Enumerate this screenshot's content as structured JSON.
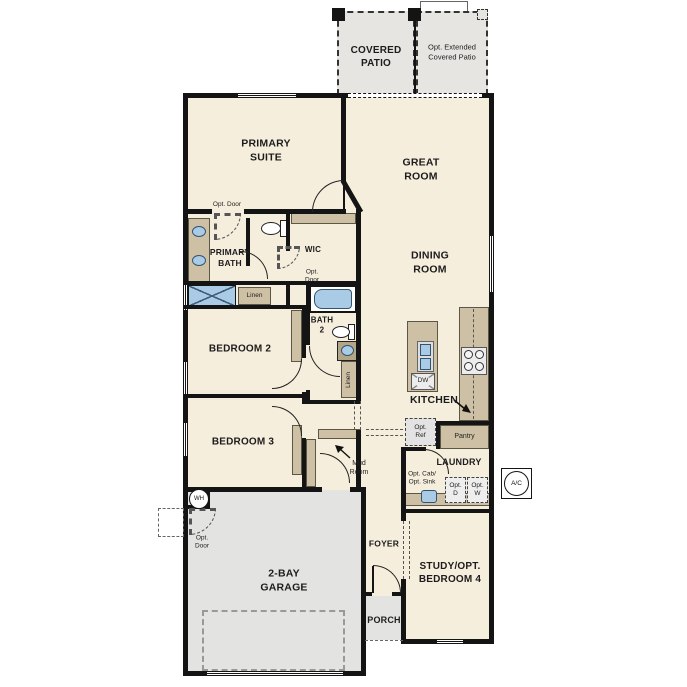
{
  "plan": {
    "rooms": {
      "covered_patio": "COVERED\nPATIO",
      "opt_extended_patio": "Opt. Extended\nCovered Patio",
      "primary_suite": "PRIMARY\nSUITE",
      "great_room": "GREAT\nROOM",
      "dining_room": "DINING\nROOM",
      "primary_bath": "PRIMARY\nBATH",
      "wic": "WIC",
      "bath_2": "BATH\n2",
      "bedroom_2": "BEDROOM 2",
      "bedroom_3": "BEDROOM 3",
      "kitchen": "KITCHEN",
      "pantry": "Pantry",
      "laundry": "LAUNDRY",
      "mud_room": "Mud\nRoom",
      "foyer": "FOYER",
      "garage": "2-BAY\nGARAGE",
      "study": "STUDY/OPT.\nBEDROOM 4",
      "porch": "PORCH"
    },
    "annotations": {
      "opt_door": "Opt. Door",
      "opt_door_2line": "Opt.\nDoor",
      "linen": "Linen",
      "opt_ref": "Opt.\nRef",
      "opt_cab_sink": "Opt. Cab/\nOpt. Sink",
      "opt_dryer": "Opt.\nD",
      "opt_washer": "Opt.\nW",
      "dishwasher": "DW",
      "water_heater": "WH",
      "ac_unit": "A/C"
    },
    "colors": {
      "wall": "#141414",
      "room_fill": "#f6eedd",
      "cabinet_fill": "#cec0a4",
      "patio_fill": "#e6e5e2",
      "garage_fill": "#e3e3e1",
      "fixture_blue": "#a9cbe5"
    }
  }
}
